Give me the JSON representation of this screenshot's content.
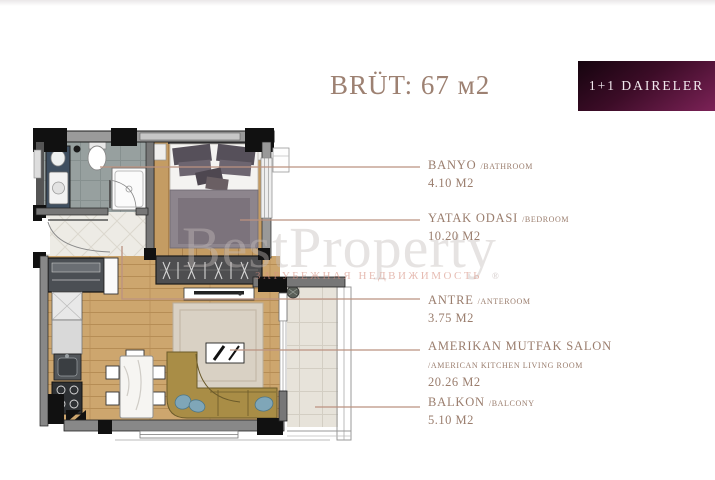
{
  "header": {
    "title": "BRÜT: 67 м2",
    "badge": "1+1 DAIRELER"
  },
  "watermark": {
    "brand": "BestProperty",
    "subtitle": "ЗАРУБЕЖНАЯ НЕДВИЖИМОСТЬ",
    "mark": "®"
  },
  "rooms": [
    {
      "name": "BANYO",
      "alt": "/BATHROOM",
      "area": "4.10 M2"
    },
    {
      "name": "YATAK ODASI",
      "alt": "/BEDROOM",
      "area": "10.20 M2"
    },
    {
      "name": "ANTRE",
      "alt": "/ANTEROOM",
      "area": "3.75 M2"
    },
    {
      "name": "AMERIKAN MUTFAK SALON",
      "alt": "/AMERICAN KITCHEN LIVING ROOM",
      "area": "20.26 M2"
    },
    {
      "name": "BALKON",
      "alt": "/BALCONY",
      "area": "5.10 M2"
    }
  ],
  "colors": {
    "title_text": "#9d8172",
    "label_text": "#9a7d6d",
    "leader_line": "#bb9280",
    "badge_dark": "#15040e",
    "badge_purple": "#7c2257",
    "badge_text": "#f2e9ee",
    "wood_floor": "#c9a36b",
    "bathroom_tile": "#97a09f",
    "entry_tile": "#edebe5",
    "balcony_tile": "#e7e3da",
    "sofa": "#a98d46",
    "sofa_pillow": "#7fa6b8",
    "walls": "#111111",
    "watermark_gray": "#c4bdba",
    "watermark_pink": "#d69080"
  }
}
